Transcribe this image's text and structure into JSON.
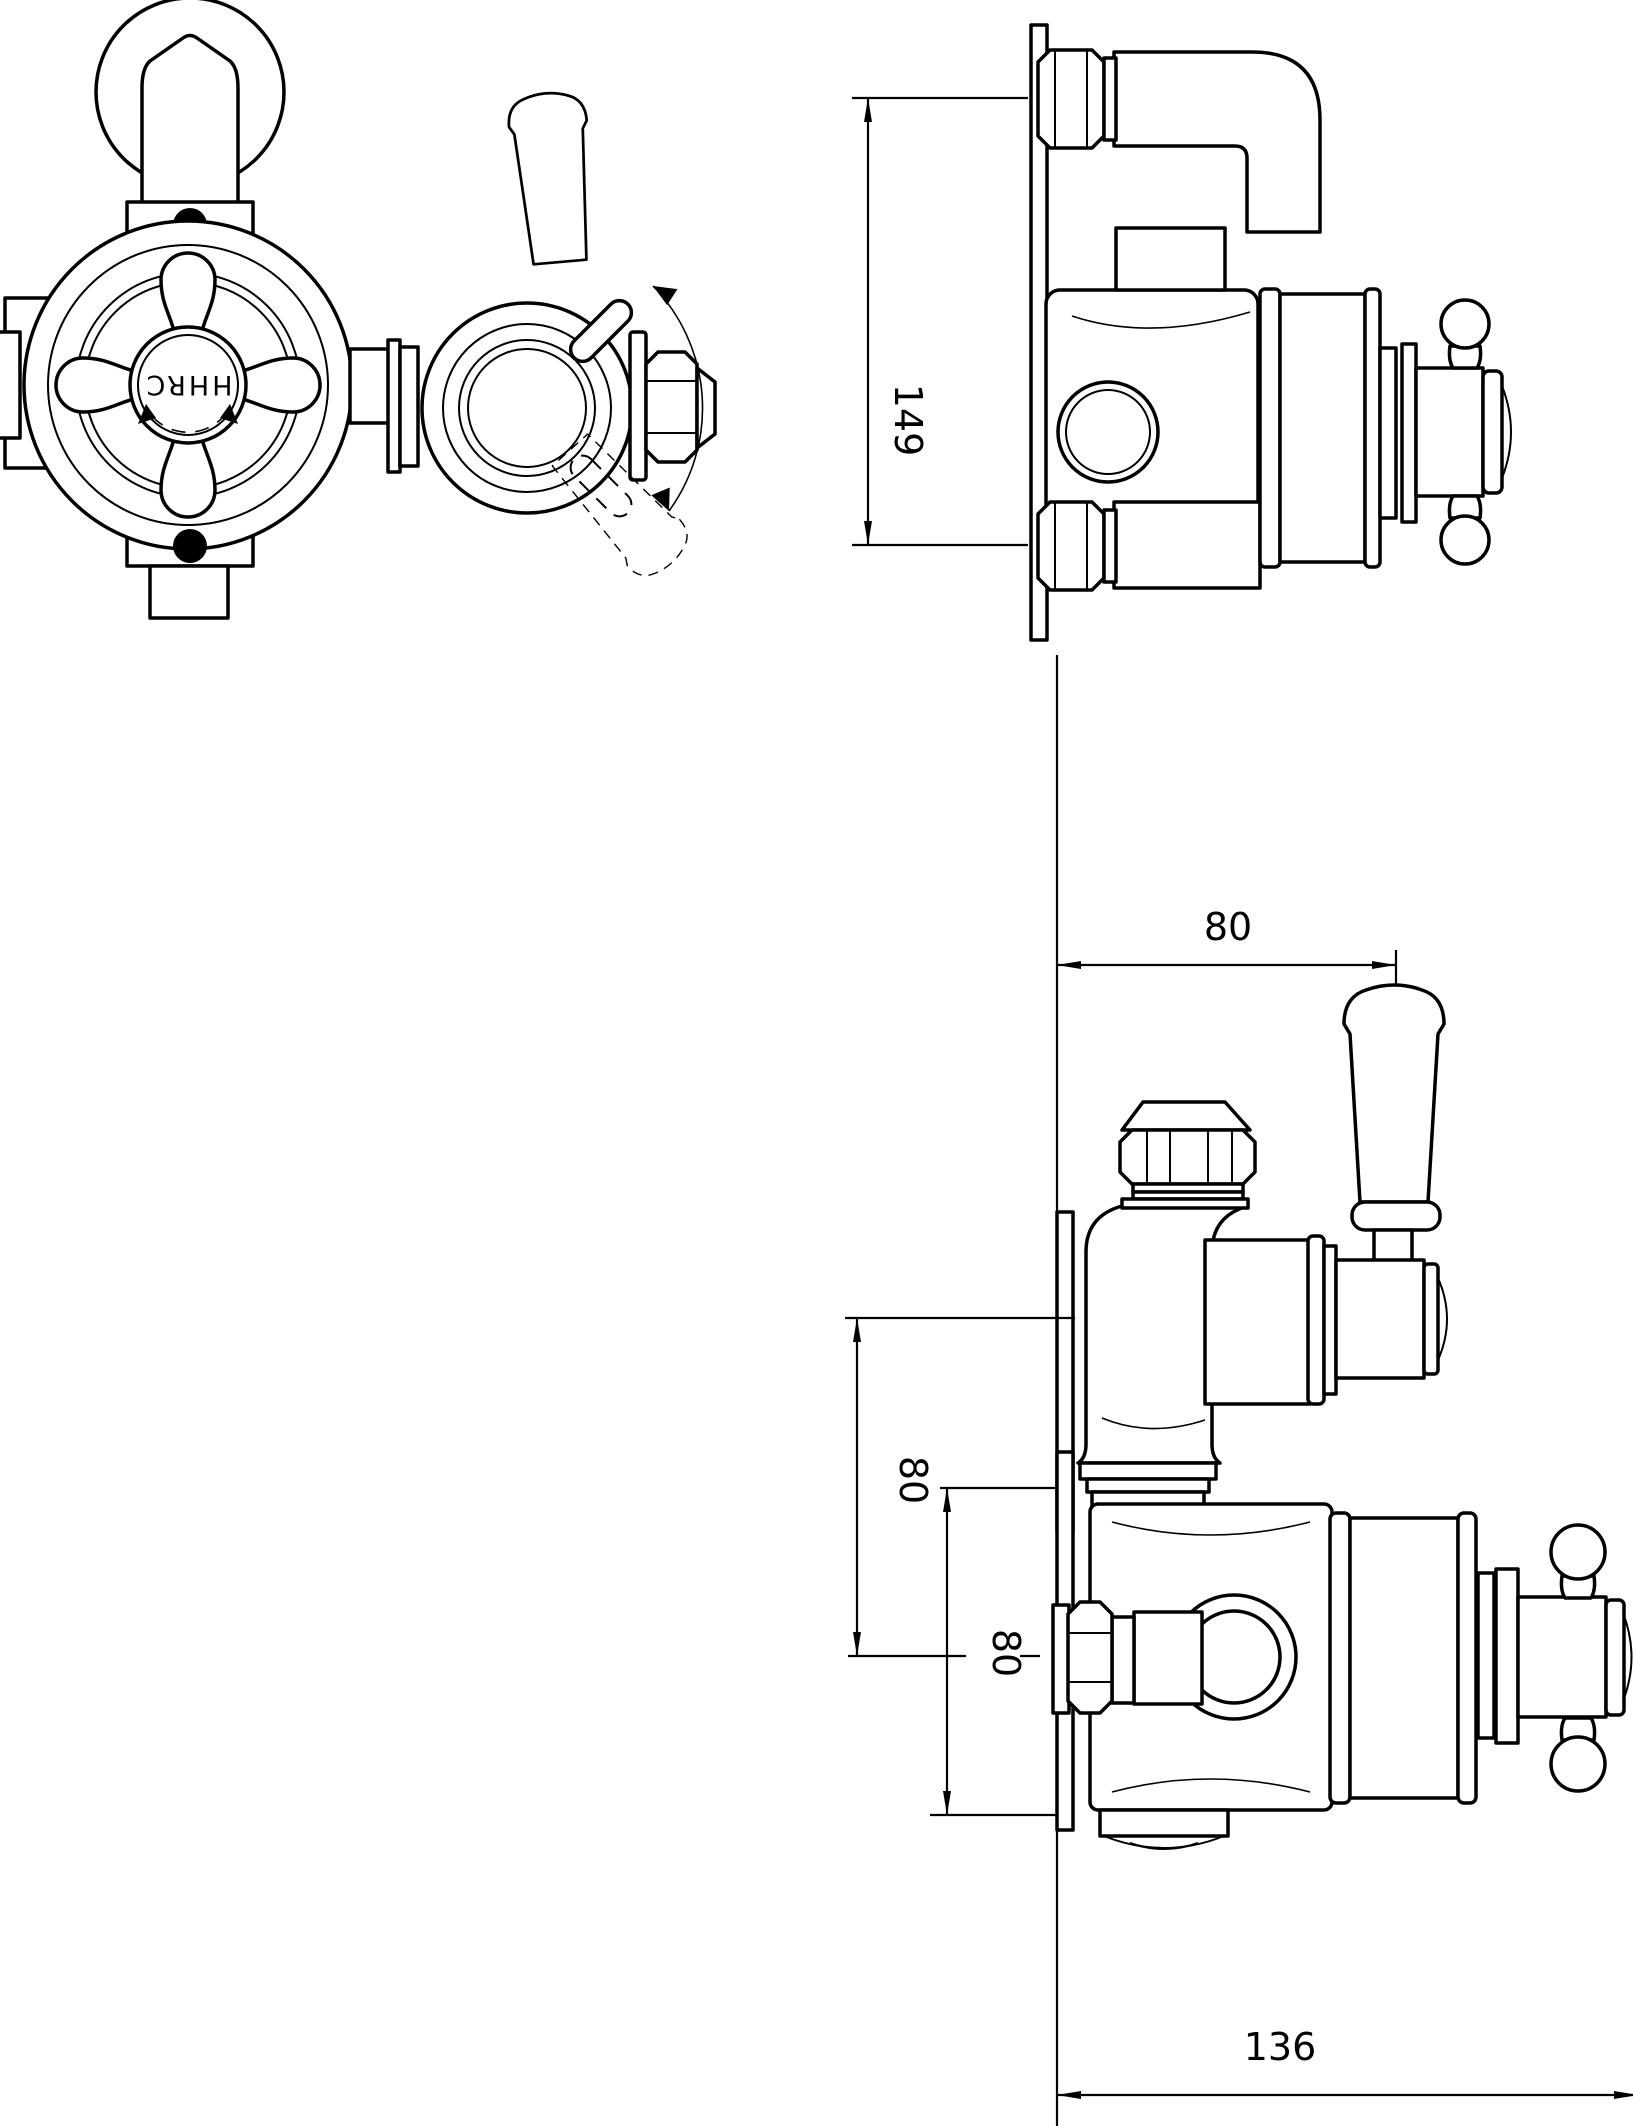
{
  "drawing": {
    "type": "technical-dimension-drawing",
    "subject": "exposed twin thermostatic shower valve",
    "background_color": "#ffffff",
    "line_color": "#000000",
    "views": {
      "plan": {
        "label": "plan-view-with-crosshead-and-diverter-lever"
      },
      "side": {
        "label": "side-elevation"
      },
      "front": {
        "label": "front-elevation"
      }
    },
    "plan": {
      "hub_marking": "HHRC"
    },
    "dimensions": {
      "side_height": {
        "value": "149"
      },
      "front_width_top": {
        "value": "80"
      },
      "front_spacing_upper": {
        "value": "80"
      },
      "front_spacing_lower": {
        "value": "80"
      },
      "front_width_bottom": {
        "value": "136"
      }
    }
  }
}
